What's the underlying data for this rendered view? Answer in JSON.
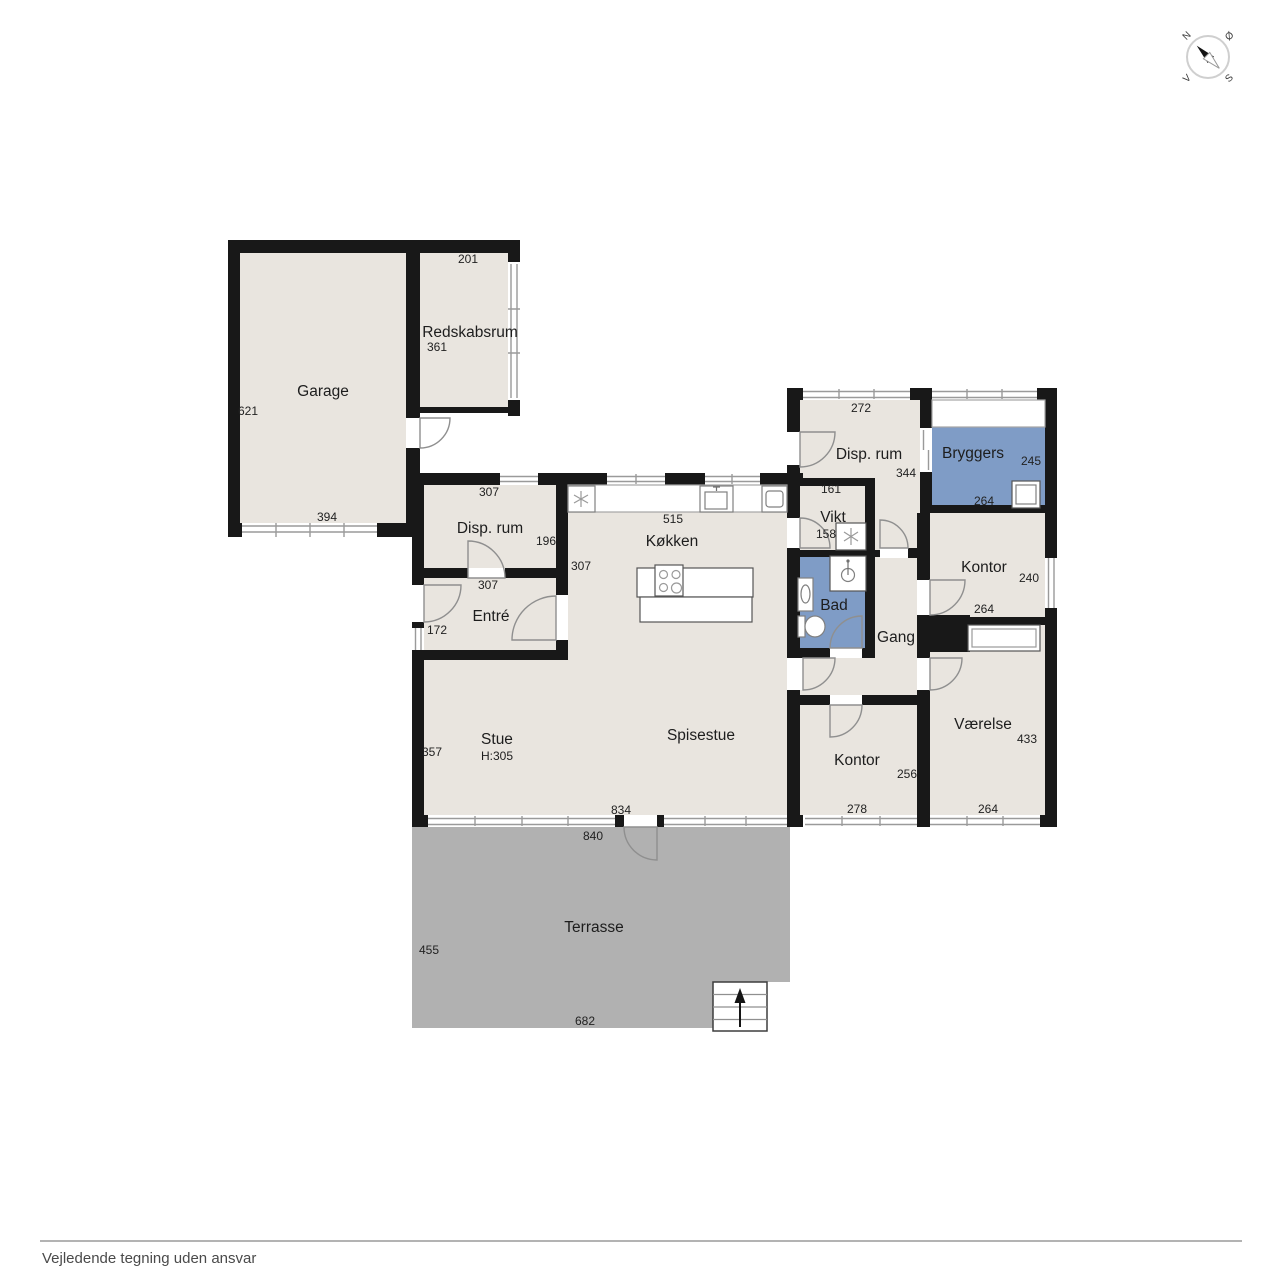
{
  "footer": {
    "disclaimer": "Vejledende tegning uden ansvar"
  },
  "compass": {
    "north": "N",
    "east": "Ø",
    "south": "S",
    "west": "V"
  },
  "colors": {
    "floor": "#e9e5df",
    "wet_room": "#7f9cc6",
    "terrace": "#b1b1b1",
    "wall": "#181818"
  },
  "rooms": [
    {
      "id": "garage",
      "label": "Garage"
    },
    {
      "id": "redskabsrum",
      "label": "Redskabsrum"
    },
    {
      "id": "disp-rum-vest",
      "label": "Disp. rum"
    },
    {
      "id": "entre",
      "label": "Entré"
    },
    {
      "id": "kokken",
      "label": "Køkken"
    },
    {
      "id": "stue",
      "label": "Stue",
      "height_note": "H:305"
    },
    {
      "id": "spisestue",
      "label": "Spisestue"
    },
    {
      "id": "terrasse",
      "label": "Terrasse"
    },
    {
      "id": "disp-rum-ost",
      "label": "Disp. rum"
    },
    {
      "id": "bryggers",
      "label": "Bryggers"
    },
    {
      "id": "vikt",
      "label": "Vikt"
    },
    {
      "id": "bad",
      "label": "Bad"
    },
    {
      "id": "gang",
      "label": "Gang"
    },
    {
      "id": "kontor-nord",
      "label": "Kontor"
    },
    {
      "id": "vaerelse",
      "label": "Værelse"
    },
    {
      "id": "kontor-syd",
      "label": "Kontor"
    }
  ],
  "dimensions_cm": [
    {
      "room": "redskabsrum",
      "value": "201"
    },
    {
      "room": "redskabsrum",
      "value": "361"
    },
    {
      "room": "garage",
      "value": "621"
    },
    {
      "room": "garage",
      "value": "394"
    },
    {
      "room": "disp-rum-vest",
      "value": "307"
    },
    {
      "room": "disp-rum-vest",
      "value": "196"
    },
    {
      "room": "entre",
      "value": "307"
    },
    {
      "room": "entre",
      "value": "172"
    },
    {
      "room": "kokken",
      "value": "515"
    },
    {
      "room": "kokken",
      "value": "307"
    },
    {
      "room": "stue",
      "value": "357"
    },
    {
      "room": "stue",
      "value": "834"
    },
    {
      "room": "terrasse",
      "value": "840"
    },
    {
      "room": "terrasse",
      "value": "455"
    },
    {
      "room": "terrasse",
      "value": "682"
    },
    {
      "room": "disp-rum-ost",
      "value": "272"
    },
    {
      "room": "disp-rum-ost",
      "value": "344"
    },
    {
      "room": "vikt",
      "value": "161"
    },
    {
      "room": "vikt",
      "value": "158"
    },
    {
      "room": "bryggers",
      "value": "245"
    },
    {
      "room": "bryggers",
      "value": "264"
    },
    {
      "room": "kontor-nord",
      "value": "240"
    },
    {
      "room": "kontor-nord",
      "value": "264"
    },
    {
      "room": "kontor-syd",
      "value": "256"
    },
    {
      "room": "kontor-syd",
      "value": "278"
    },
    {
      "room": "vaerelse",
      "value": "433"
    },
    {
      "room": "vaerelse",
      "value": "264"
    }
  ]
}
